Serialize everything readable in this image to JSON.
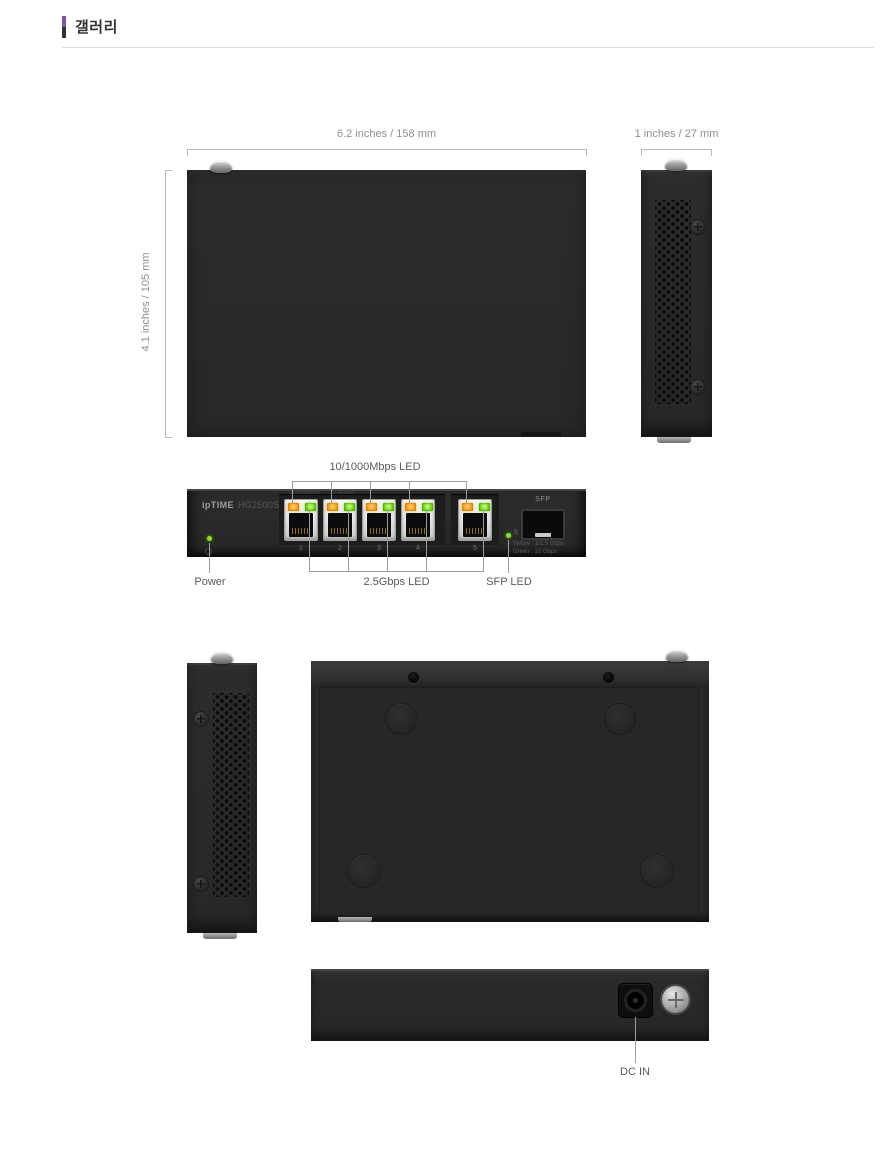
{
  "header": {
    "title": "갤러리"
  },
  "top_view": {
    "width_label": "6.2 inches / 158 mm",
    "height_label": "4.1 inches / 105 mm"
  },
  "side_view": {
    "depth_label": "1 inches / 27 mm"
  },
  "front_view": {
    "brand": "ipTIME",
    "model": "HG2500ST1",
    "panel_print_left": "10/1000Mbps",
    "panel_print_right": "2.5Gbps",
    "port_numbers": [
      "1",
      "2",
      "3",
      "4",
      "5"
    ],
    "sfp_label": "SFP",
    "sfp_led_mark": "S",
    "legend": [
      "- Yellow : 1/2.5 Gbps",
      "- Green : 10 Gbps"
    ]
  },
  "annotations": {
    "uplink_led": "10/1000Mbps LED",
    "power": "Power",
    "speed_led": "2.5Gbps LED",
    "sfp_led": "SFP LED",
    "dc_in": "DC IN"
  },
  "colors": {
    "accent_purple": "#7a55b8",
    "led_orange": "#f5a01e",
    "led_green": "#77d41c",
    "body_dark": "#2b2b2b"
  }
}
